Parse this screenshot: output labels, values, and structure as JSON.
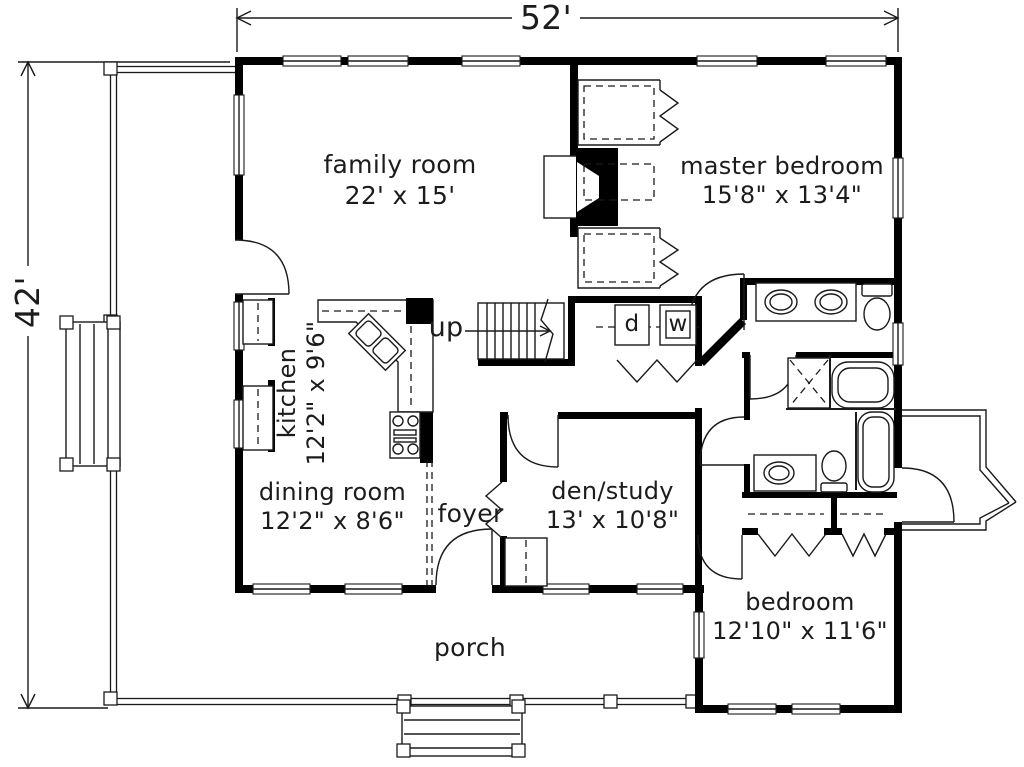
{
  "floor_plan": {
    "overall_width": "52'",
    "overall_height": "42'",
    "rooms": [
      {
        "id": "family_room",
        "name": "family room",
        "size": "22' x 15'"
      },
      {
        "id": "master_bedroom",
        "name": "master bedroom",
        "size": "15'8\" x 13'4\""
      },
      {
        "id": "kitchen",
        "name": "kitchen",
        "size": "12'2\" x 9'6\""
      },
      {
        "id": "dining_room",
        "name": "dining room",
        "size": "12'2\" x 8'6\""
      },
      {
        "id": "foyer",
        "name": "foyer",
        "size": ""
      },
      {
        "id": "den_study",
        "name": "den/study",
        "size": "13' x 10'8\""
      },
      {
        "id": "bedroom",
        "name": "bedroom",
        "size": "12'10\" x 11'6\""
      },
      {
        "id": "porch",
        "name": "porch",
        "size": ""
      }
    ],
    "annotations": {
      "stairs_direction": "up",
      "dryer": "d",
      "washer": "w"
    },
    "colors": {
      "walls": "#000000",
      "background": "#ffffff",
      "lines": "#1a1a1a"
    }
  }
}
